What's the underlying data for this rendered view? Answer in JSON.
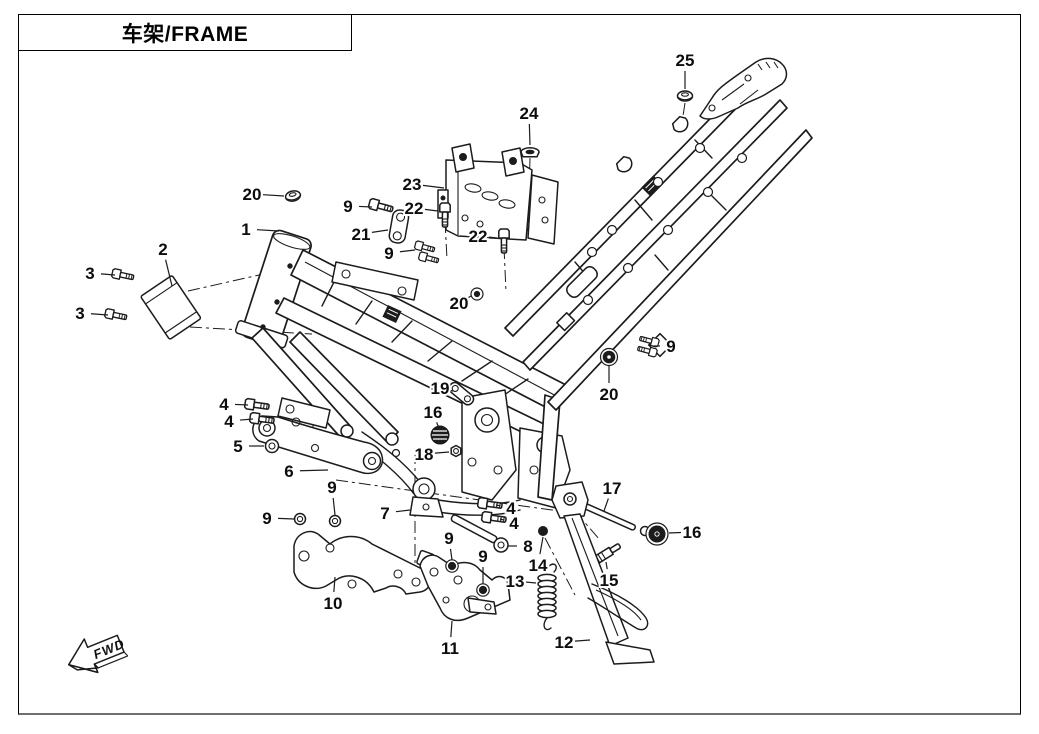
{
  "title_box": {
    "title": "车架/FRAME"
  },
  "direction_indicator": {
    "label": "FWD"
  },
  "diagram": {
    "ink_color": "#1c1c1c",
    "border_color": "#000000",
    "callouts": [
      {
        "label": "25",
        "x": 685,
        "y": 60,
        "tx": 685,
        "ty": 89
      },
      {
        "label": "24",
        "x": 529,
        "y": 113,
        "tx": 530,
        "ty": 145
      },
      {
        "label": "23",
        "x": 412,
        "y": 184,
        "tx": 444,
        "ty": 188
      },
      {
        "label": "20",
        "x": 252,
        "y": 194,
        "tx": 284,
        "ty": 196
      },
      {
        "label": "9",
        "x": 348,
        "y": 206,
        "tx": 372,
        "ty": 207
      },
      {
        "label": "22",
        "x": 414,
        "y": 208,
        "tx": 438,
        "ty": 211
      },
      {
        "label": "1",
        "x": 246,
        "y": 229,
        "tx": 279,
        "ty": 231
      },
      {
        "label": "21",
        "x": 361,
        "y": 234,
        "tx": 388,
        "ty": 230
      },
      {
        "label": "22",
        "x": 478,
        "y": 236,
        "tx": 497,
        "ty": 238
      },
      {
        "label": "9",
        "x": 389,
        "y": 253,
        "tx": 415,
        "ty": 250
      },
      {
        "label": "2",
        "x": 163,
        "y": 249,
        "tx": 172,
        "ty": 286
      },
      {
        "label": "3",
        "x": 90,
        "y": 273,
        "tx": 115,
        "ty": 275
      },
      {
        "label": "3",
        "x": 80,
        "y": 313,
        "tx": 108,
        "ty": 315
      },
      {
        "label": "20",
        "x": 459,
        "y": 303,
        "tx": 471,
        "ty": 296
      },
      {
        "label": "9",
        "x": 671,
        "y": 346,
        "tx": 652,
        "ty": 346
      },
      {
        "label": "20",
        "x": 609,
        "y": 394,
        "tx": 609,
        "ty": 366
      },
      {
        "label": "19",
        "x": 440,
        "y": 388,
        "tx": 453,
        "ty": 391
      },
      {
        "label": "16",
        "x": 433,
        "y": 412,
        "tx": 438,
        "ty": 426
      },
      {
        "label": "18",
        "x": 424,
        "y": 454,
        "tx": 449,
        "ty": 452
      },
      {
        "label": "4",
        "x": 224,
        "y": 404,
        "tx": 248,
        "ty": 405
      },
      {
        "label": "4",
        "x": 229,
        "y": 421,
        "tx": 253,
        "ty": 419
      },
      {
        "label": "5",
        "x": 238,
        "y": 446,
        "tx": 264,
        "ty": 446
      },
      {
        "label": "6",
        "x": 289,
        "y": 471,
        "tx": 328,
        "ty": 470
      },
      {
        "label": "9",
        "x": 332,
        "y": 487,
        "tx": 335,
        "ty": 515
      },
      {
        "label": "9",
        "x": 267,
        "y": 518,
        "tx": 294,
        "ty": 519
      },
      {
        "label": "7",
        "x": 385,
        "y": 513,
        "tx": 410,
        "ty": 510
      },
      {
        "label": "4",
        "x": 511,
        "y": 508,
        "tx": 496,
        "ty": 505
      },
      {
        "label": "4",
        "x": 514,
        "y": 523,
        "tx": 500,
        "ty": 519
      },
      {
        "label": "8",
        "x": 528,
        "y": 546,
        "tx": 508,
        "ty": 546
      },
      {
        "label": "9",
        "x": 449,
        "y": 538,
        "tx": 452,
        "ty": 560
      },
      {
        "label": "9",
        "x": 483,
        "y": 556,
        "tx": 483,
        "ty": 584
      },
      {
        "label": "14",
        "x": 538,
        "y": 565,
        "tx": 543,
        "ty": 537
      },
      {
        "label": "13",
        "x": 515,
        "y": 581,
        "tx": 536,
        "ty": 583
      },
      {
        "label": "15",
        "x": 609,
        "y": 580,
        "tx": 606,
        "ty": 562
      },
      {
        "label": "17",
        "x": 612,
        "y": 488,
        "tx": 604,
        "ty": 511
      },
      {
        "label": "16",
        "x": 692,
        "y": 532,
        "tx": 669,
        "ty": 533
      },
      {
        "label": "10",
        "x": 333,
        "y": 603,
        "tx": 335,
        "ty": 577
      },
      {
        "label": "11",
        "x": 450,
        "y": 648,
        "tx": 452,
        "ty": 621
      },
      {
        "label": "12",
        "x": 564,
        "y": 642,
        "tx": 590,
        "ty": 640
      }
    ]
  }
}
